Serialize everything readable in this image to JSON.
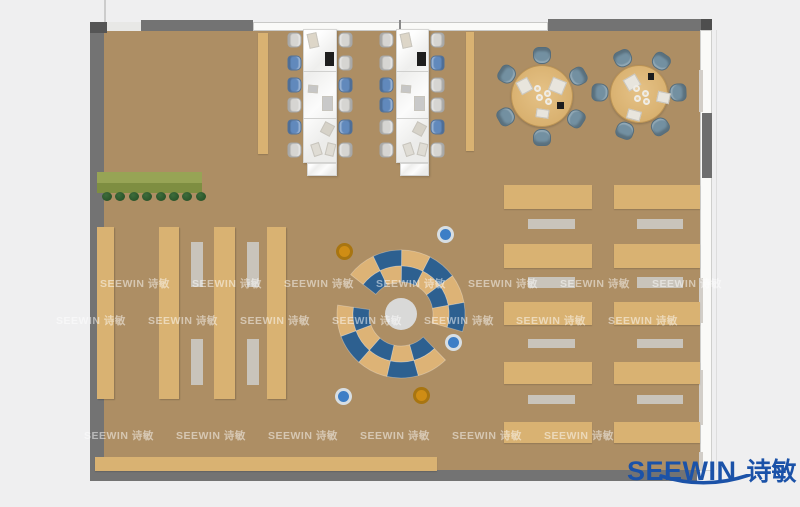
{
  "meta": {
    "width": 800,
    "height": 507,
    "description": "Top-down rendered floor plan of a library / open office furnished space"
  },
  "logo": {
    "text_en": "SEEWIN",
    "text_cn": "诗敏",
    "color": "#1b52a8"
  },
  "watermark": {
    "text": "SEEWIN 诗敏",
    "spacing": 92,
    "rows": [
      {
        "y": 276,
        "x0": 100,
        "count": 7
      },
      {
        "y": 313,
        "x0": 56,
        "count": 7
      },
      {
        "y": 428,
        "x0": 84,
        "count": 6
      }
    ]
  },
  "palette": {
    "floor": "#ad8e64",
    "wood": "#d9b272",
    "wall": "#737373",
    "white_table": "#f4f4f3",
    "bench": "#c9c4bb",
    "chair_gray": "#d6d5d2",
    "chair_blue": "#6189bc",
    "chair_slate": "#7390a1",
    "arc_blue": "#2d6090",
    "arc_tan": "#ddb376",
    "planter_top": "#97a455",
    "planter_bottom": "#7e8e41",
    "plant": "#2c5930",
    "stool_blue": "#3d7ec6",
    "stool_blue_ring": "#d7dee3",
    "stool_orange": "#cf8d15",
    "stool_orange_ring": "#a87511",
    "center_circle": "#d9d9d8",
    "window_white": "#fafaf8"
  },
  "floorplan": {
    "rects": [
      {
        "n": "wood-floor",
        "x": 104,
        "y": 30,
        "w": 596,
        "h": 441,
        "c": "floor",
        "cls": "floor"
      },
      {
        "n": "door-gap",
        "x": 104,
        "y": 22,
        "w": 37,
        "h": 9,
        "c": "#e8e8e6"
      },
      {
        "n": "top-window-band",
        "x": 253,
        "y": 22,
        "w": 295,
        "h": 9,
        "c": "window_white",
        "cls": "winband"
      },
      {
        "n": "window-divider",
        "x": 399,
        "y": 20,
        "w": 2,
        "h": 11,
        "c": "#8a8a8a"
      },
      {
        "n": "left-wall",
        "x": 90,
        "y": 22,
        "w": 14,
        "h": 459,
        "c": "wall"
      },
      {
        "n": "left-wall-cap",
        "x": 90,
        "y": 22,
        "w": 17,
        "h": 11,
        "c": "#555555"
      },
      {
        "n": "top-wall-left",
        "x": 141,
        "y": 20,
        "w": 112,
        "h": 11,
        "c": "wall"
      },
      {
        "n": "top-wall-right",
        "x": 548,
        "y": 19,
        "w": 155,
        "h": 12,
        "c": "wall"
      },
      {
        "n": "top-wall-right-cap",
        "x": 701,
        "y": 19,
        "w": 11,
        "h": 12,
        "c": "#4e4e4e"
      },
      {
        "n": "bottom-wall",
        "x": 90,
        "y": 470,
        "w": 607,
        "h": 11,
        "c": "wall"
      },
      {
        "n": "right-window-band",
        "x": 700,
        "y": 30,
        "w": 12,
        "h": 441,
        "c": "window_white",
        "cls": "winband-v"
      },
      {
        "n": "right-wall-block",
        "x": 699,
        "y": 70,
        "w": 4,
        "h": 42,
        "c": "#d2cec8"
      },
      {
        "n": "right-wall-pillar",
        "x": 702,
        "y": 113,
        "w": 10,
        "h": 65,
        "c": "#6e6e6e"
      },
      {
        "n": "right-wall-block",
        "x": 699,
        "y": 278,
        "w": 4,
        "h": 45,
        "c": "#d2cec8"
      },
      {
        "n": "right-wall-block",
        "x": 699,
        "y": 370,
        "w": 4,
        "h": 55,
        "c": "#d2cec8"
      },
      {
        "n": "right-wall-block",
        "x": 699,
        "y": 452,
        "w": 4,
        "h": 18,
        "c": "#d2cec8"
      },
      {
        "n": "exterior-line",
        "x": 104,
        "y": 0,
        "w": 2,
        "h": 22,
        "c": "#cccccc"
      },
      {
        "n": "exterior-line",
        "x": 716,
        "y": 30,
        "w": 1,
        "h": 440,
        "c": "#dddddd"
      },
      {
        "n": "planter-box",
        "x": 97,
        "y": 172,
        "w": 105,
        "h": 11,
        "c": "planter_top"
      },
      {
        "n": "planter-box",
        "x": 97,
        "y": 183,
        "w": 105,
        "h": 10,
        "c": "planter_bottom"
      },
      {
        "n": "side-bench",
        "x": 258,
        "y": 33,
        "w": 10,
        "h": 121,
        "c": "wood",
        "cls": "desk"
      },
      {
        "n": "side-bench",
        "x": 466,
        "y": 32,
        "w": 8,
        "h": 119,
        "c": "wood",
        "cls": "desk"
      },
      {
        "n": "bookshelf",
        "x": 97,
        "y": 227,
        "w": 17,
        "h": 172,
        "c": "wood",
        "cls": "shelf"
      },
      {
        "n": "bookshelf",
        "x": 159,
        "y": 227,
        "w": 20,
        "h": 172,
        "c": "wood",
        "cls": "shelf"
      },
      {
        "n": "bookshelf",
        "x": 214,
        "y": 227,
        "w": 21,
        "h": 172,
        "c": "wood",
        "cls": "shelf"
      },
      {
        "n": "bookshelf",
        "x": 267,
        "y": 227,
        "w": 19,
        "h": 172,
        "c": "wood",
        "cls": "shelf"
      },
      {
        "n": "study-table",
        "x": 191,
        "y": 242,
        "w": 12,
        "h": 45,
        "c": "bench"
      },
      {
        "n": "study-table",
        "x": 247,
        "y": 242,
        "w": 12,
        "h": 45,
        "c": "bench"
      },
      {
        "n": "study-table",
        "x": 191,
        "y": 339,
        "w": 12,
        "h": 46,
        "c": "bench"
      },
      {
        "n": "study-table",
        "x": 247,
        "y": 339,
        "w": 12,
        "h": 46,
        "c": "bench"
      },
      {
        "n": "desk-row",
        "x": 504,
        "y": 185,
        "w": 88,
        "h": 24,
        "c": "wood",
        "cls": "desk"
      },
      {
        "n": "desk-row",
        "x": 504,
        "y": 244,
        "w": 88,
        "h": 24,
        "c": "wood",
        "cls": "desk"
      },
      {
        "n": "desk-row",
        "x": 504,
        "y": 302,
        "w": 88,
        "h": 23,
        "c": "wood",
        "cls": "desk"
      },
      {
        "n": "desk-row",
        "x": 504,
        "y": 362,
        "w": 88,
        "h": 22,
        "c": "wood",
        "cls": "desk"
      },
      {
        "n": "desk-row",
        "x": 504,
        "y": 422,
        "w": 88,
        "h": 21,
        "c": "wood",
        "cls": "desk"
      },
      {
        "n": "desk-row",
        "x": 614,
        "y": 185,
        "w": 86,
        "h": 24,
        "c": "wood",
        "cls": "desk"
      },
      {
        "n": "desk-row",
        "x": 614,
        "y": 244,
        "w": 86,
        "h": 24,
        "c": "wood",
        "cls": "desk"
      },
      {
        "n": "desk-row",
        "x": 614,
        "y": 302,
        "w": 86,
        "h": 23,
        "c": "wood",
        "cls": "desk"
      },
      {
        "n": "desk-row",
        "x": 614,
        "y": 362,
        "w": 86,
        "h": 22,
        "c": "wood",
        "cls": "desk"
      },
      {
        "n": "desk-row",
        "x": 614,
        "y": 422,
        "w": 86,
        "h": 21,
        "c": "wood",
        "cls": "desk"
      },
      {
        "n": "bench-seat",
        "x": 528,
        "y": 219,
        "w": 47,
        "h": 10,
        "c": "bench"
      },
      {
        "n": "bench-seat",
        "x": 528,
        "y": 277,
        "w": 47,
        "h": 11,
        "c": "bench"
      },
      {
        "n": "bench-seat",
        "x": 528,
        "y": 339,
        "w": 47,
        "h": 9,
        "c": "bench"
      },
      {
        "n": "bench-seat",
        "x": 528,
        "y": 395,
        "w": 47,
        "h": 9,
        "c": "bench"
      },
      {
        "n": "bench-seat",
        "x": 637,
        "y": 219,
        "w": 46,
        "h": 10,
        "c": "bench"
      },
      {
        "n": "bench-seat",
        "x": 637,
        "y": 277,
        "w": 46,
        "h": 11,
        "c": "bench"
      },
      {
        "n": "bench-seat",
        "x": 637,
        "y": 339,
        "w": 46,
        "h": 9,
        "c": "bench"
      },
      {
        "n": "bench-seat",
        "x": 637,
        "y": 395,
        "w": 46,
        "h": 9,
        "c": "bench"
      },
      {
        "n": "bottom-counter",
        "x": 95,
        "y": 457,
        "w": 342,
        "h": 14,
        "c": "wood",
        "cls": "desk"
      }
    ],
    "plants": {
      "x0": 102,
      "y": 192,
      "step": 13.4,
      "count": 8,
      "d": 10
    },
    "chair_ys": [
      33,
      56,
      78,
      98,
      120,
      143
    ],
    "chair_size": {
      "w": 15,
      "h": 14
    },
    "workstations": [
      {
        "table": {
          "x": 303,
          "y": 29,
          "w": 34,
          "h": 134
        },
        "footer": {
          "x": 307,
          "y": 163,
          "w": 30,
          "h": 13
        },
        "dividers": [
          71,
          118
        ],
        "chairs_left": {
          "x": 287,
          "colors": [
            "gray",
            "blue",
            "blue",
            "gray",
            "blue",
            "gray"
          ]
        },
        "chairs_right": {
          "x": 338,
          "colors": [
            "gray",
            "gray",
            "blue",
            "gray",
            "blue",
            "gray"
          ]
        },
        "items": [
          {
            "dx": 5,
            "y": 33,
            "w": 10,
            "h": 15,
            "rot": -12,
            "c": "#ddd6c8"
          },
          {
            "dx": 22,
            "y": 52,
            "w": 9,
            "h": 14,
            "rot": 0,
            "c": "#1e1e1e"
          },
          {
            "dx": 5,
            "y": 85,
            "w": 10,
            "h": 8,
            "rot": 4,
            "c": "#c6c6c6"
          },
          {
            "dx": 19,
            "y": 96,
            "w": 11,
            "h": 15,
            "rot": 0,
            "c": "#c9c9c9"
          },
          {
            "dx": 19,
            "y": 123,
            "w": 11,
            "h": 12,
            "rot": 28,
            "c": "#d6d2c8"
          },
          {
            "dx": 9,
            "y": 143,
            "w": 9,
            "h": 13,
            "rot": -18,
            "c": "#dfdcd4"
          },
          {
            "dx": 23,
            "y": 143,
            "w": 9,
            "h": 13,
            "rot": 14,
            "c": "#dfdcd4"
          }
        ]
      },
      {
        "table": {
          "x": 396,
          "y": 29,
          "w": 33,
          "h": 134
        },
        "footer": {
          "x": 400,
          "y": 163,
          "w": 29,
          "h": 13
        },
        "dividers": [
          71,
          118
        ],
        "chairs_left": {
          "x": 379,
          "colors": [
            "gray",
            "gray",
            "blue",
            "blue",
            "gray",
            "gray"
          ]
        },
        "chairs_right": {
          "x": 430,
          "colors": [
            "gray",
            "blue",
            "gray",
            "gray",
            "blue",
            "gray"
          ]
        },
        "items": [
          {
            "dx": 5,
            "y": 33,
            "w": 10,
            "h": 15,
            "rot": -12,
            "c": "#ddd6c8"
          },
          {
            "dx": 21,
            "y": 52,
            "w": 9,
            "h": 14,
            "rot": 0,
            "c": "#1e1e1e"
          },
          {
            "dx": 5,
            "y": 85,
            "w": 10,
            "h": 8,
            "rot": 4,
            "c": "#c6c6c6"
          },
          {
            "dx": 18,
            "y": 96,
            "w": 11,
            "h": 15,
            "rot": 0,
            "c": "#c9c9c9"
          },
          {
            "dx": 18,
            "y": 123,
            "w": 11,
            "h": 12,
            "rot": 28,
            "c": "#d6d2c8"
          },
          {
            "dx": 8,
            "y": 143,
            "w": 9,
            "h": 13,
            "rot": -18,
            "c": "#dfdcd4"
          },
          {
            "dx": 22,
            "y": 143,
            "w": 9,
            "h": 13,
            "rot": 14,
            "c": "#dfdcd4"
          }
        ]
      }
    ],
    "round_tables": [
      {
        "cx": 542,
        "cy": 96,
        "r": 31,
        "chair_dist": 41,
        "chair_angles": [
          0,
          61,
          123,
          180,
          240,
          302
        ],
        "papers": [
          {
            "dx": -24,
            "dy": -17,
            "w": 13,
            "h": 14,
            "rot": -28
          },
          {
            "dx": 8,
            "dy": -17,
            "w": 15,
            "h": 14,
            "rot": 22
          },
          {
            "dx": -6,
            "dy": 13,
            "w": 13,
            "h": 9,
            "rot": 8
          }
        ],
        "black": {
          "dx": 15,
          "dy": 6,
          "w": 7,
          "h": 7
        },
        "plates": [
          {
            "dx": -8,
            "dy": -11
          },
          {
            "dx": 2,
            "dy": -6
          },
          {
            "dx": -6,
            "dy": -2
          },
          {
            "dx": 3,
            "dy": 2
          }
        ]
      },
      {
        "cx": 639,
        "cy": 94,
        "r": 29,
        "chair_dist": 39,
        "chair_angles": [
          335,
          34,
          88,
          147,
          201,
          272
        ],
        "papers": [
          {
            "dx": -14,
            "dy": -18,
            "w": 14,
            "h": 13,
            "rot": -30
          },
          {
            "dx": 18,
            "dy": -2,
            "w": 13,
            "h": 11,
            "rot": 12
          },
          {
            "dx": -12,
            "dy": 16,
            "w": 14,
            "h": 10,
            "rot": 15
          }
        ],
        "black": {
          "dx": 9,
          "dy": -21,
          "w": 6,
          "h": 7
        },
        "plates": [
          {
            "dx": -6,
            "dy": -9
          },
          {
            "dx": 3,
            "dy": -4
          },
          {
            "dx": -5,
            "dy": 1
          },
          {
            "dx": 4,
            "dy": 4
          }
        ]
      }
    ],
    "amphitheater": {
      "svg": {
        "x": 326,
        "y": 239,
        "size": 150
      },
      "cx": 401,
      "cy": 314,
      "center_r": 16,
      "rings": [
        {
          "r0": 48,
          "r1": 64,
          "a0": -52,
          "a1": 106,
          "colors": [
            "tan",
            "blue",
            "tan",
            "blue",
            "tan",
            "blue"
          ]
        },
        {
          "r0": 32,
          "r1": 48,
          "a0": -52,
          "a1": 106,
          "colors": [
            "blue",
            "tan",
            "blue",
            "tan",
            "blue",
            "tan"
          ]
        },
        {
          "r0": 48,
          "r1": 64,
          "a0": 136,
          "a1": 278,
          "colors": [
            "tan",
            "blue",
            "tan",
            "blue",
            "tan"
          ]
        },
        {
          "r0": 32,
          "r1": 48,
          "a0": 136,
          "a1": 278,
          "colors": [
            "blue",
            "tan",
            "blue",
            "tan",
            "blue"
          ]
        }
      ]
    },
    "stools": [
      {
        "x": 445,
        "y": 234,
        "c": "blue"
      },
      {
        "x": 453,
        "y": 342,
        "c": "blue"
      },
      {
        "x": 343,
        "y": 396,
        "c": "blue"
      },
      {
        "x": 344,
        "y": 251,
        "c": "orange"
      },
      {
        "x": 421,
        "y": 395,
        "c": "orange"
      }
    ]
  }
}
